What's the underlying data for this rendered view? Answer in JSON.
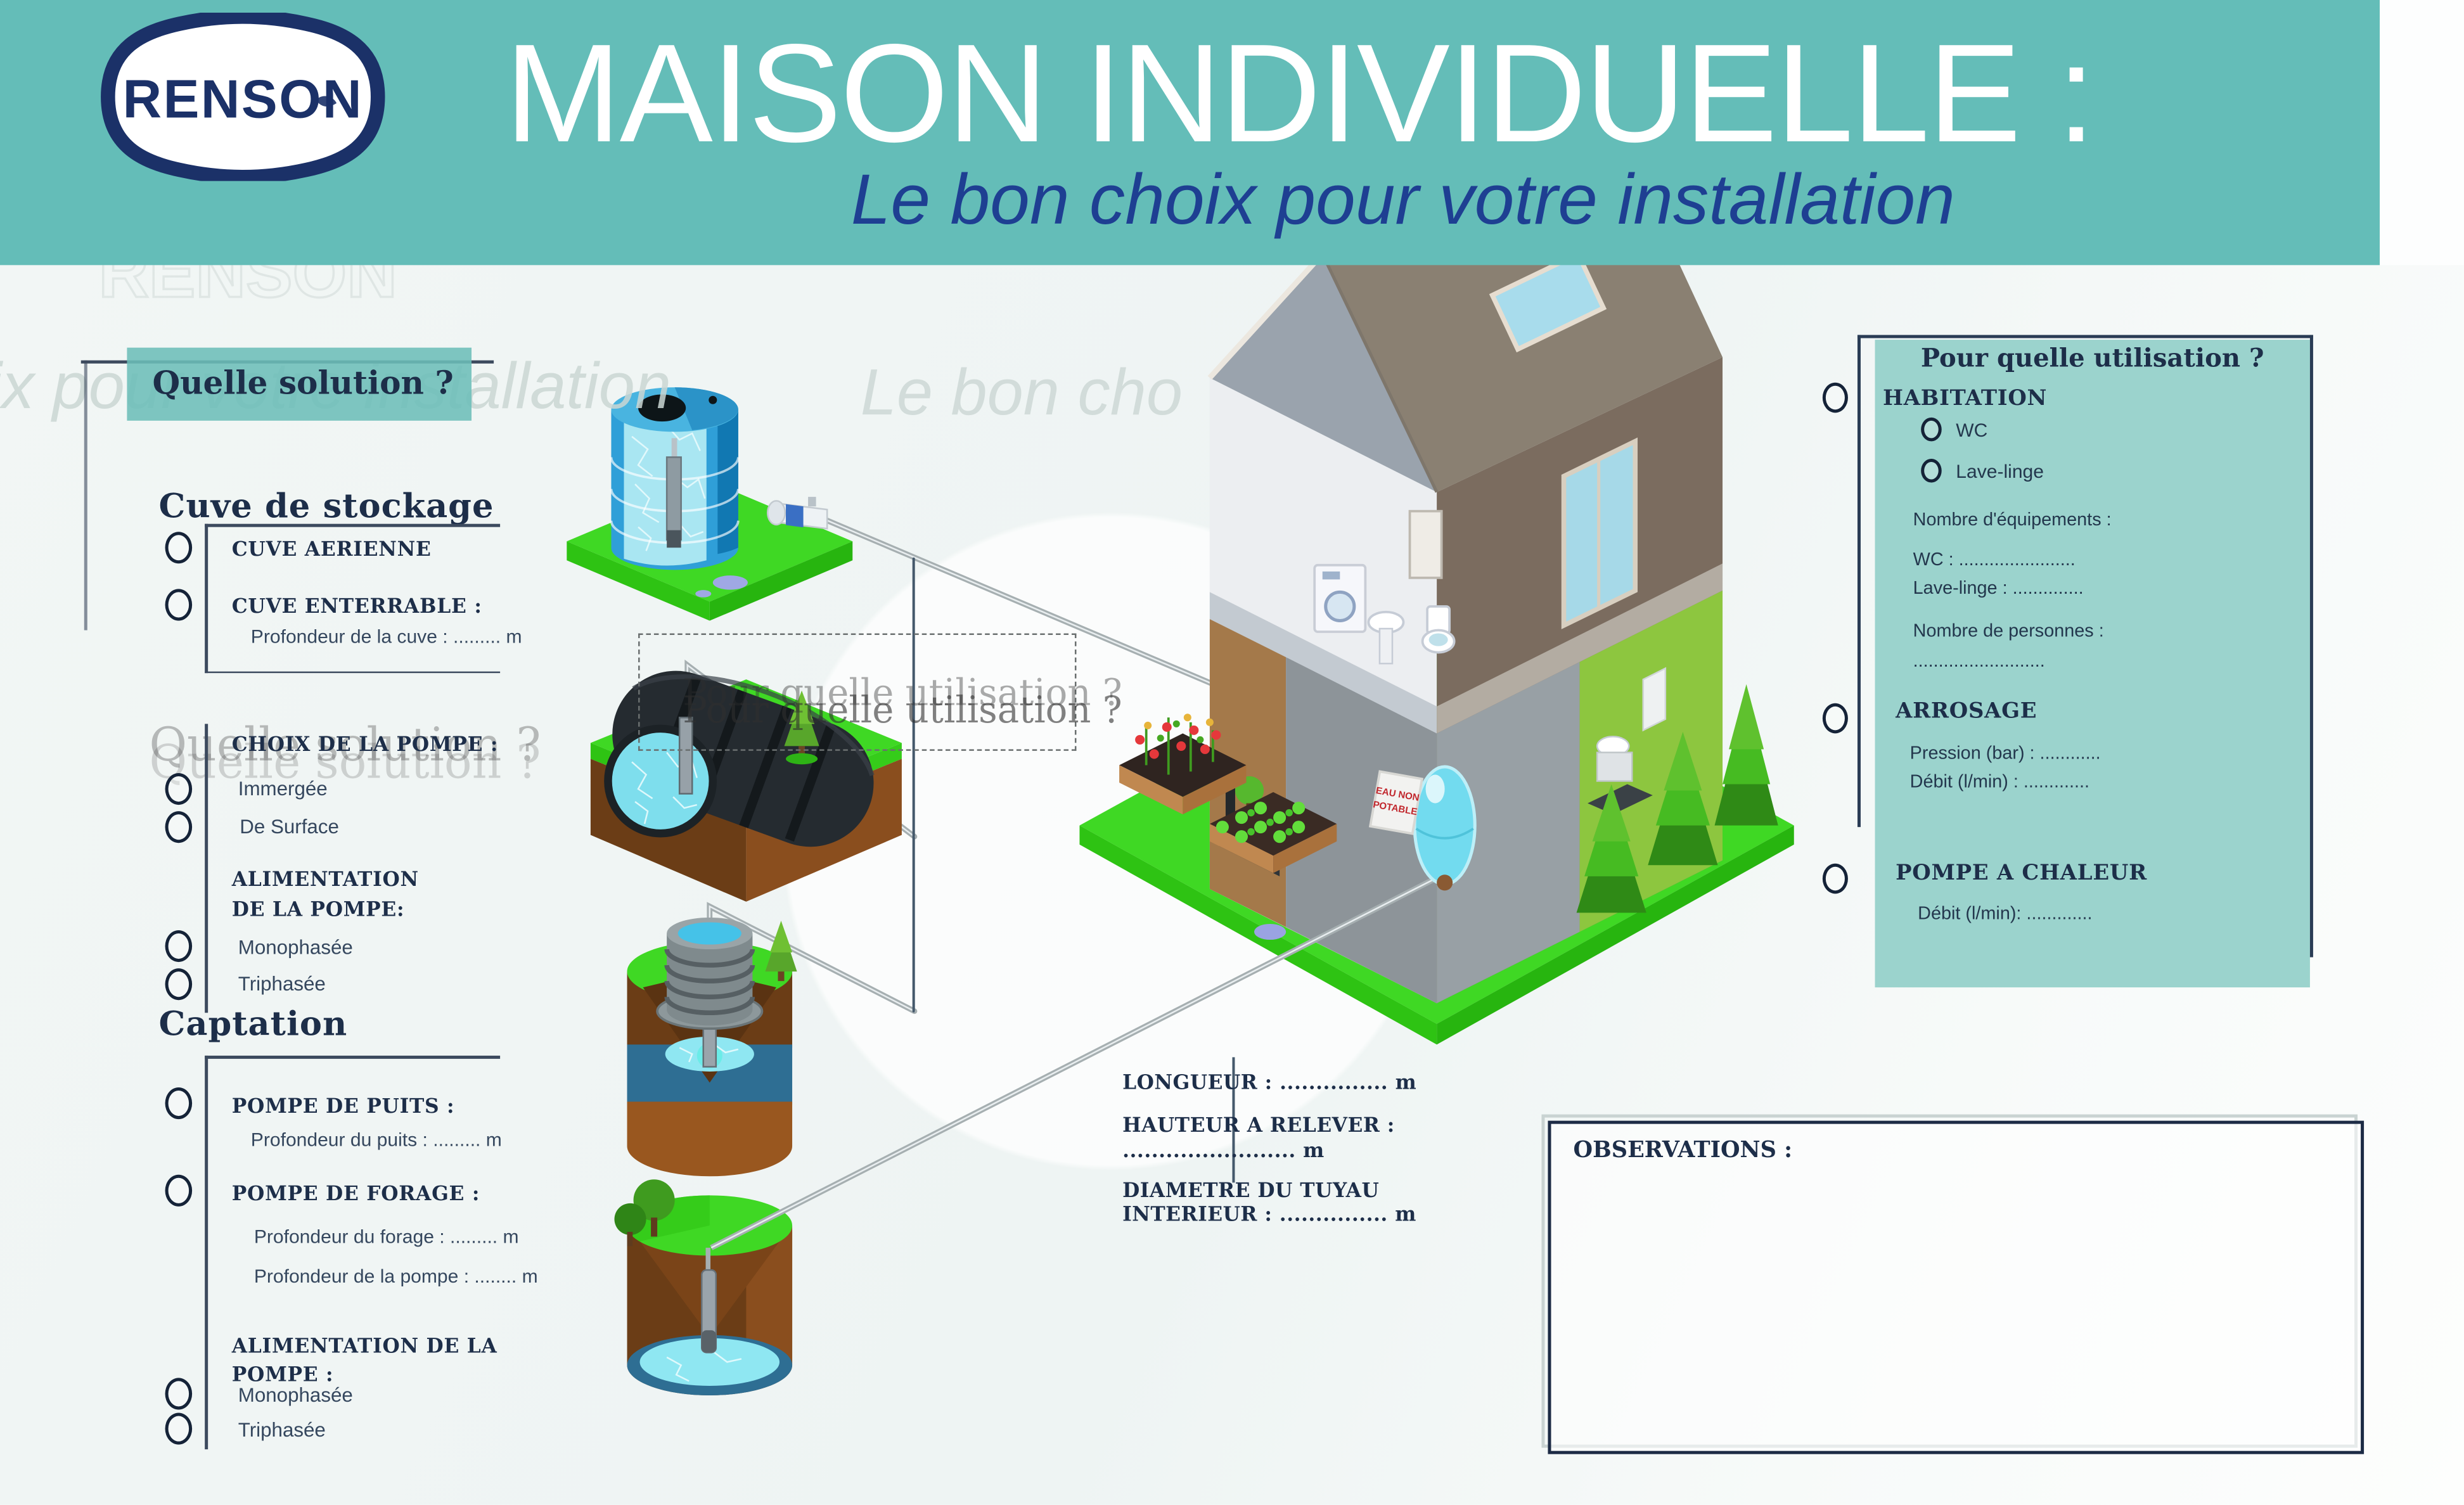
{
  "header": {
    "logo_text": "RENSON",
    "title": "MAISON INDIVIDUELLE :",
    "subtitle": "Le bon choix pour votre installation",
    "colors": {
      "band": "#64bdb8",
      "title": "#ffffff",
      "subtitle": "#1e3f92",
      "logo_navy": "#1b3168"
    }
  },
  "left_panel": {
    "question_label": "Quelle solution ?",
    "storage": {
      "heading": "Cuve de stockage",
      "option_aerial": "CUVE AERIENNE",
      "option_buried": "CUVE ENTERRABLE :",
      "buried_detail": "Profondeur de la cuve : ......... m"
    },
    "pump_choice": {
      "heading": "CHOIX DE LA POMPE :",
      "option_submerged": "Immergée",
      "option_surface": "De Surface",
      "power_line1": "ALIMENTATION",
      "power_line2": "DE LA POMPE:",
      "power_mono": "Monophasée",
      "power_tri": "Triphasée"
    },
    "captation": {
      "heading": "Captation",
      "option_well": "POMPE DE PUITS :",
      "well_detail": "Profondeur du puits : ......... m",
      "option_borehole": "POMPE DE FORAGE :",
      "borehole_detail1": "Profondeur du forage : ......... m",
      "borehole_detail2": "Profondeur de la pompe : ........ m",
      "power_line1": "ALIMENTATION DE LA",
      "power_line2": "POMPE :",
      "power_mono": "Monophasée",
      "power_tri": "Triphasée"
    }
  },
  "right_panel": {
    "title": "Pour quelle utilisation ?",
    "habitation": {
      "label": "HABITATION",
      "option_wc": "WC",
      "option_washer": "Lave-linge",
      "equip_label": "Nombre d'équipements :",
      "wc_line": "WC : .......................",
      "washer_line": "Lave-linge : ..............",
      "persons_label": "Nombre de personnes :",
      "persons_line": ".........................."
    },
    "arrosage": {
      "label": "ARROSAGE",
      "pressure_line": "Pression (bar) : ............",
      "flow_line": "Débit (l/min) : ............."
    },
    "heat_pump": {
      "label": "POMPE A CHALEUR",
      "flow_line": "Débit (l/min): ............."
    }
  },
  "measurements": {
    "length_line": "LONGUEUR : ............... m",
    "lift_label": "HAUTEUR A RELEVER :",
    "lift_line": "........................ m",
    "pipe_label_line1": "DIAMETRE DU TUYAU",
    "pipe_label_line2": "INTERIEUR : ............... m"
  },
  "observations": {
    "label": "OBSERVATIONS :"
  },
  "house": {
    "sign_line1": "EAU NON",
    "sign_line2": "POTABLE"
  },
  "watermarks": {
    "renson": "RENSON",
    "subtitle_left": "ix pour votre installation",
    "subtitle_center": "Le bon cho",
    "solution": "Quelle solution ?",
    "utilisation": "Pour quelle utilisation ?"
  },
  "palette": {
    "header_teal": "#64bdb8",
    "panel_teal": "#9bd3cd",
    "navy": "#1b3168",
    "lawn_green": "#3fd824",
    "soil_brown": "#6b3d16",
    "water_cyan": "#7edeed",
    "sign_red": "#c1272d"
  }
}
